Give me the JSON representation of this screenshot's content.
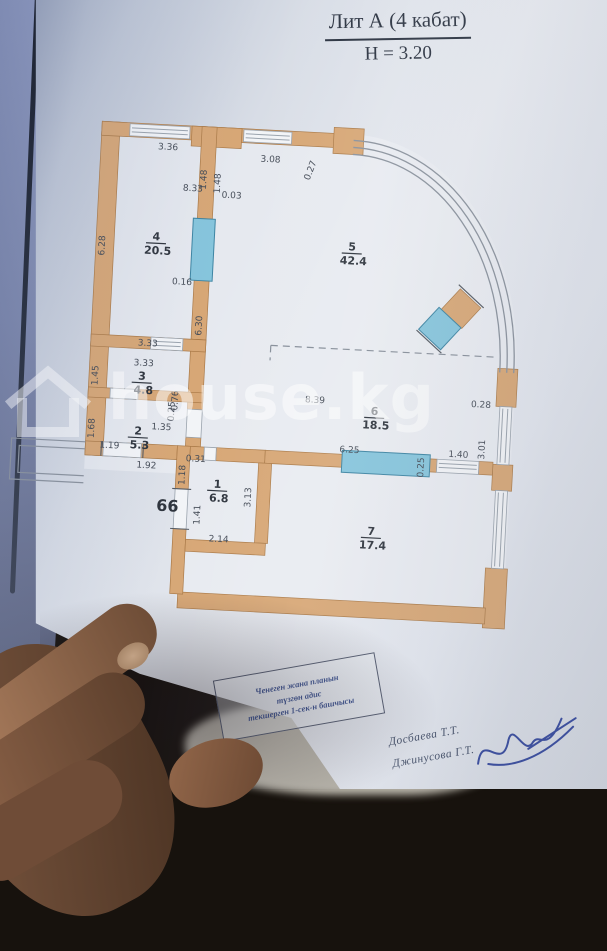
{
  "title": {
    "line1": "Лит А (4 кабат)",
    "line2": "Н = 3.20"
  },
  "watermark": {
    "text": "house.kg",
    "icon": "house-icon",
    "color": "rgba(255,255,255,0.52)"
  },
  "plan": {
    "apartment_number": "66",
    "wall_color": "#d7a776",
    "door_color": "#86c5dc",
    "rooms": [
      {
        "num": "4",
        "area": "20.5",
        "x": 148,
        "y": 248
      },
      {
        "num": "5",
        "area": "42.4",
        "x": 344,
        "y": 248
      },
      {
        "num": "3",
        "area": "4.8",
        "x": 141,
        "y": 388
      },
      {
        "num": "2",
        "area": "5.3",
        "x": 140,
        "y": 443
      },
      {
        "num": "1",
        "area": "6.8",
        "x": 222,
        "y": 492
      },
      {
        "num": "6",
        "area": "18.5",
        "x": 375,
        "y": 411
      },
      {
        "num": "7",
        "area": "17.4",
        "x": 378,
        "y": 531
      }
    ],
    "dimensions": [
      {
        "t": "3.36",
        "x": 155,
        "y": 157,
        "r": 0
      },
      {
        "t": "1.48",
        "x": 195,
        "y": 185,
        "r": -90
      },
      {
        "t": "1.48",
        "x": 209,
        "y": 188,
        "r": -90
      },
      {
        "t": "8.33",
        "x": 182,
        "y": 197,
        "r": 0
      },
      {
        "t": "0.03",
        "x": 221,
        "y": 202,
        "r": 0
      },
      {
        "t": "3.08",
        "x": 258,
        "y": 164,
        "r": 0
      },
      {
        "t": "0.27",
        "x": 301,
        "y": 171,
        "r": -72
      },
      {
        "t": "6.28",
        "x": 97,
        "y": 256,
        "r": -90
      },
      {
        "t": "0.16",
        "x": 176,
        "y": 291,
        "r": 0
      },
      {
        "t": "6.30",
        "x": 198,
        "y": 331,
        "r": -90
      },
      {
        "t": "3.33",
        "x": 145,
        "y": 354,
        "r": 0
      },
      {
        "t": "3.33",
        "x": 142,
        "y": 374,
        "r": 0
      },
      {
        "t": "1.45",
        "x": 97,
        "y": 386,
        "r": -90
      },
      {
        "t": "0.76",
        "x": 178,
        "y": 407,
        "r": -90
      },
      {
        "t": "1.35",
        "x": 163,
        "y": 437,
        "r": 0
      },
      {
        "t": "1.68",
        "x": 96,
        "y": 439,
        "r": -90
      },
      {
        "t": "0.25",
        "x": 175,
        "y": 418,
        "r": -90
      },
      {
        "t": "1.19",
        "x": 112,
        "y": 458,
        "r": 0
      },
      {
        "t": "1.92",
        "x": 150,
        "y": 476,
        "r": 0
      },
      {
        "t": "0.31",
        "x": 199,
        "y": 467,
        "r": 0
      },
      {
        "t": "1.18",
        "x": 189,
        "y": 481,
        "r": -90
      },
      {
        "t": "1.41",
        "x": 206,
        "y": 520,
        "r": -90
      },
      {
        "t": "2.14",
        "x": 226,
        "y": 546,
        "r": 0
      },
      {
        "t": "3.13",
        "x": 256,
        "y": 500,
        "r": -90
      },
      {
        "t": "8.39",
        "x": 315,
        "y": 402,
        "r": 0
      },
      {
        "t": "0.28",
        "x": 481,
        "y": 398,
        "r": 0
      },
      {
        "t": "3.01",
        "x": 487,
        "y": 440,
        "r": -90
      },
      {
        "t": "6.25",
        "x": 352,
        "y": 450,
        "r": 0
      },
      {
        "t": "0.25",
        "x": 427,
        "y": 461,
        "r": -90
      },
      {
        "t": "1.40",
        "x": 461,
        "y": 449,
        "r": 0
      }
    ]
  },
  "stamp": {
    "lines": [
      "Ченеген жана планын",
      "түзгөн адис",
      "текшерген 1-сек-н башчысы"
    ]
  },
  "signatures": [
    {
      "name": "Досбаева  Т.Т."
    },
    {
      "name": "Джинусова  Г.Т."
    }
  ]
}
